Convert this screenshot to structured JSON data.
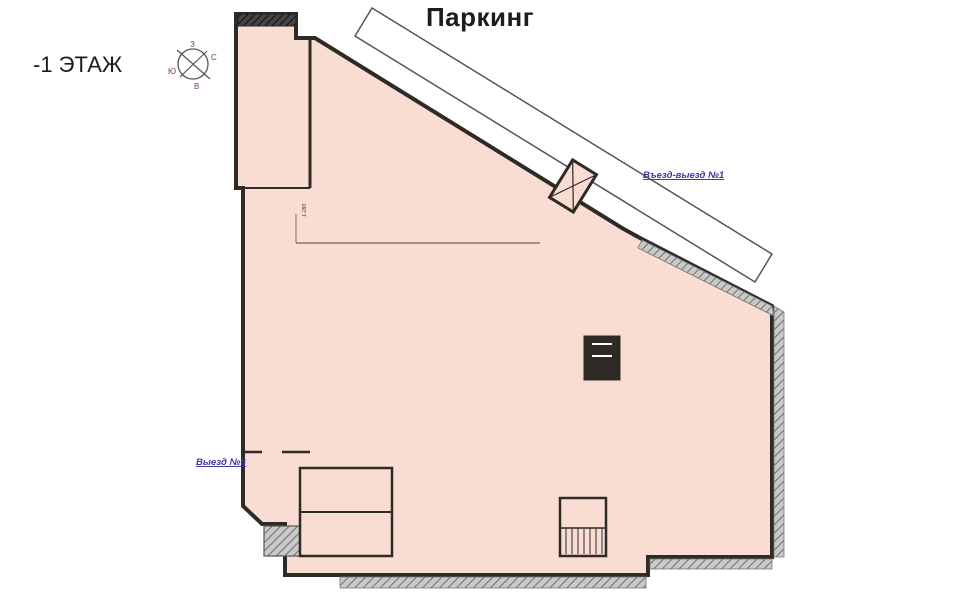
{
  "page": {
    "title": "Паркинг",
    "floor_label": "-1 ЭТАЖ"
  },
  "compass": {
    "top": "З",
    "right": "С",
    "bottom": "В",
    "left": "Ю"
  },
  "labels": {
    "entry_exit": "Въезд-выезд №1",
    "exit6": "Выезд №6"
  },
  "watermark": {
    "line1": "OFFICE",
    "line2": "НАВИГАТОР",
    "fragment": "NAVI"
  },
  "colors": {
    "plan_fill": "#f9ddd2",
    "wall": "#2e2a26",
    "stall_line": "#6b6560",
    "arrow_blue": "#4038aa",
    "label_blue": "#3b35a8",
    "hatch_gray": "#9a9a9a",
    "number_ink": "#3d3d3d"
  },
  "stalls": {
    "left_column": [
      "1-227",
      "1-226",
      "1-225",
      "1-91",
      "1-90",
      "1-89",
      "1-88",
      "1-87",
      "1-86",
      "1-85",
      "1-82",
      "1-81",
      "1-80",
      "1-50",
      "1-49",
      "1-48",
      "1-47"
    ],
    "tower_left": [
      "1-228",
      "1-229",
      "1-230"
    ],
    "tower": [
      "1-235",
      "1-236",
      "1-237",
      "1-238",
      "1-239",
      "1-240",
      "1-241",
      "1-242",
      "1-243"
    ],
    "diagonal": [
      "1-244",
      "1-245",
      "1-246",
      "1-247",
      "1-248",
      "1-249"
    ],
    "bankA_top": [
      "1-280",
      "1-281",
      "1-282",
      "1-283",
      "1-284",
      "1-285",
      "1-286",
      "1-287",
      "1-288",
      "1-289",
      "1-290",
      "1-291",
      "1-292",
      "1-293",
      "1-294"
    ],
    "bankA_bottom": [
      "1-84",
      "1-85",
      "1-86",
      "1-87",
      "1-88",
      "1-89",
      "1-90",
      "1-91",
      "1-92",
      "1-93",
      "1-94",
      "1-95",
      "1-96",
      "1-97",
      "1-98"
    ],
    "bankB_top": [
      "1-99",
      "1-100",
      "1-101",
      "1-102",
      "1-103",
      "1-104",
      "1-105",
      "1-106",
      "1-107",
      "1-108",
      "1-109",
      "1-110",
      "1-111",
      "1-112",
      "1-113",
      "1-114",
      "1-115",
      "1-116",
      "1-117"
    ],
    "bankB_bottom": [
      "1-118",
      "1-119",
      "1-120",
      "1-121",
      "1-122",
      "1-123",
      "1-124",
      "1-125",
      "1-126",
      "1-127",
      "1-128",
      "1-129",
      "1-130",
      "1-131",
      "1-132",
      "1-133",
      "1-134",
      "1-135",
      "1-136"
    ],
    "bankC_top_left": [
      "1-137",
      "1-138",
      "1-139",
      "1-140",
      "1-141",
      "1-142",
      "1-143",
      "1-144",
      "1-145",
      "1-146",
      "1-147",
      "1-148",
      "1-149",
      "1-150",
      "1-151",
      "1-152",
      "1-153"
    ],
    "bankC_top_right": [
      "1-350",
      "1-351",
      "1-352",
      "1-353",
      "1-354",
      "1-355",
      "1-356"
    ],
    "bankC_bottom_left": [
      "1-154",
      "1-155",
      "1-156",
      "1-157",
      "1-158",
      "1-159",
      "1-160",
      "1-161",
      "1-162",
      "1-163",
      "1-164",
      "1-165",
      "1-166",
      "1-167",
      "1-168",
      "1-169",
      "1-170"
    ],
    "bankC_bottom_right": [
      "1-357",
      "1-358",
      "1-359",
      "1-360",
      "1-361",
      "1-362",
      "1-363"
    ],
    "bankD_top_left": [
      "1-257",
      "1-258",
      "1-259",
      "1-260",
      "1-261",
      "1-262",
      "1-263",
      "1-264",
      "1-265",
      "1-266",
      "1-267",
      "1-268",
      "1-269",
      "1-270",
      "1-271",
      "1-272",
      "1-273",
      "1-274"
    ],
    "bankD_top_right": [
      "1-364",
      "1-365",
      "1-366",
      "1-367",
      "1-368",
      "1-369",
      "1-370"
    ],
    "bankD_bottom_left": [
      "1-301",
      "1-302",
      "1-303",
      "1-304",
      "1-305",
      "1-306",
      "1-307",
      "1-308",
      "1-309",
      "1-310",
      "1-311",
      "1-312",
      "1-313",
      "1-314",
      "1-315",
      "1-316",
      "1-317",
      "1-318"
    ],
    "bankD_bottom_right": [
      "1-371",
      "1-372",
      "1-373",
      "1-374",
      "1-375",
      "1-376",
      "1-377"
    ],
    "bottom_row": [
      "1-319",
      "1-320",
      "1-321",
      "1-322",
      "1-323",
      "1-324",
      "1-325",
      "1-326",
      "1-327",
      "1-328",
      "1-329",
      "1-330",
      "1-331",
      "1-332",
      "1-333",
      "1-334",
      "1-335",
      "1-336",
      "1-337",
      "1-338",
      "1-339"
    ],
    "bottom_row_right": [
      "1-340",
      "1-341",
      "1-342",
      "1-343",
      "1-344",
      "1-345",
      "1-346",
      "1-347"
    ]
  }
}
